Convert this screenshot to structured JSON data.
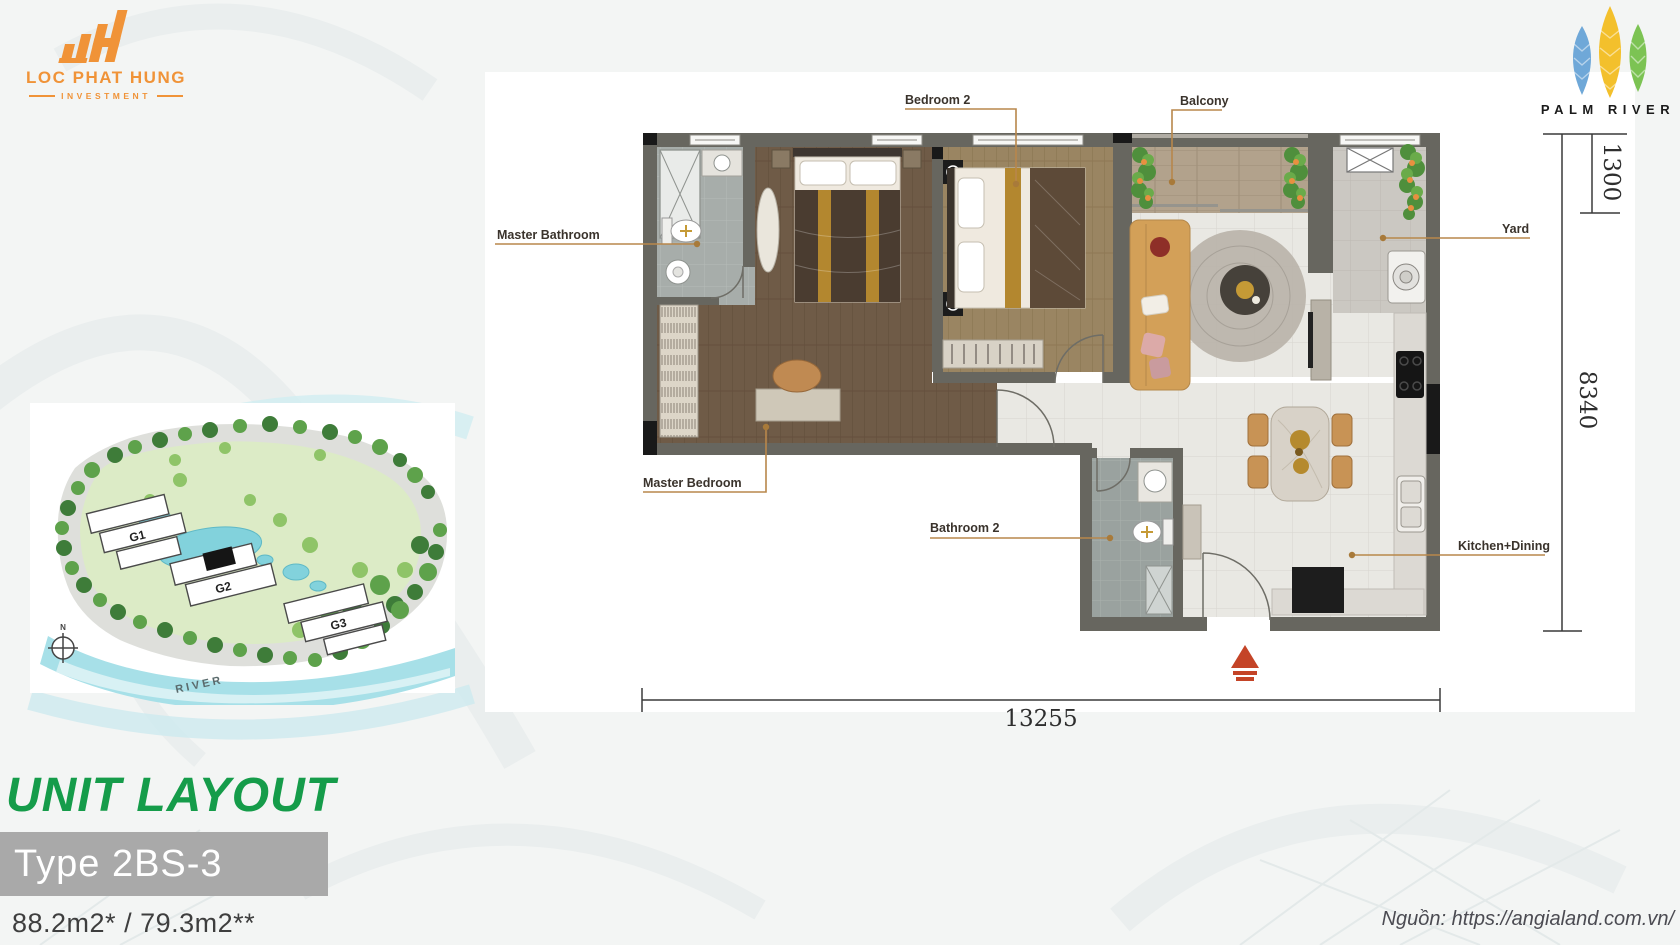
{
  "header": {
    "developer_logo": {
      "name": "LOC PHAT HUNG",
      "subtitle": "INVESTMENT"
    },
    "project_logo": {
      "name": "PALM RIVER"
    }
  },
  "floor_plan": {
    "labels": {
      "master_bathroom": "Master Bathroom",
      "bedroom2": "Bedroom 2",
      "balcony": "Balcony",
      "yard": "Yard",
      "master_bedroom": "Master Bedroom",
      "bathroom2": "Bathroom 2",
      "kitchen_dining": "Kitchen+Dining"
    },
    "dimensions": {
      "total_width": "13255",
      "total_depth": "8340",
      "balcony_depth": "1300"
    }
  },
  "site_map": {
    "buildings": [
      "G1",
      "G2",
      "G3"
    ],
    "river_label": "RIVER",
    "compass_label": "N"
  },
  "unit_info": {
    "section_title": "UNIT LAYOUT",
    "type_label": "Type 2BS-3",
    "areas": "88.2m2* / 79.3m2**"
  },
  "footer": {
    "source": "Nguồn: https://angialand.com.vn/"
  },
  "colors": {
    "accent_green": "#159c4a",
    "accent_orange": "#f09338",
    "leader_line": "#b8874b",
    "type_box_bg": "#a9a9a9",
    "wall": "#67665f",
    "entry_marker_red": "#c44427"
  }
}
